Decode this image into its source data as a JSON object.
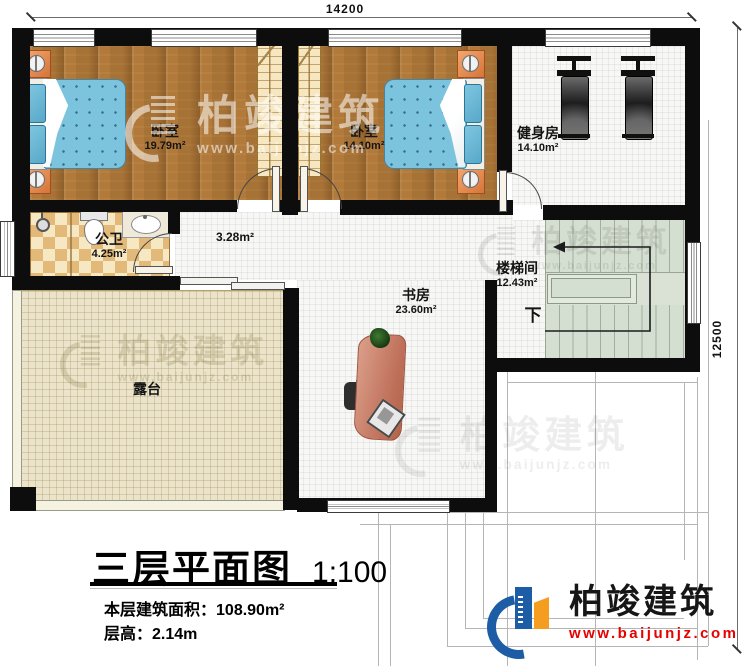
{
  "dimensions": {
    "width_mm": "14200",
    "height_mm": "12500"
  },
  "rooms": {
    "bedroom_left": {
      "name": "卧室",
      "area": "19.79m²"
    },
    "bedroom_right": {
      "name": "卧室",
      "area": "14.10m²"
    },
    "gym": {
      "name": "健身房",
      "area": "14.10m²"
    },
    "bathroom": {
      "name": "公卫",
      "area": "4.25m²"
    },
    "hallway": {
      "area": "3.28m²"
    },
    "stairwell": {
      "name": "楼梯间",
      "area": "12.43m²",
      "direction": "下"
    },
    "study": {
      "name": "书房",
      "area": "23.60m²"
    },
    "terrace": {
      "name": "露台"
    }
  },
  "title_block": {
    "title": "三层平面图",
    "scale": "1:100",
    "floor_area_label": "本层建筑面积：",
    "floor_area_value": "108.90m²",
    "floor_height_label": "层高：",
    "floor_height_value": "2.14m"
  },
  "branding": {
    "company": "柏竣建筑",
    "website": "www.baijunjz.com",
    "brand_blue": "#1d5da6",
    "brand_orange": "#f59d1e",
    "website_red": "#e60000"
  },
  "watermark": {
    "company": "柏竣建筑",
    "website": "www.baijunjz.com"
  }
}
